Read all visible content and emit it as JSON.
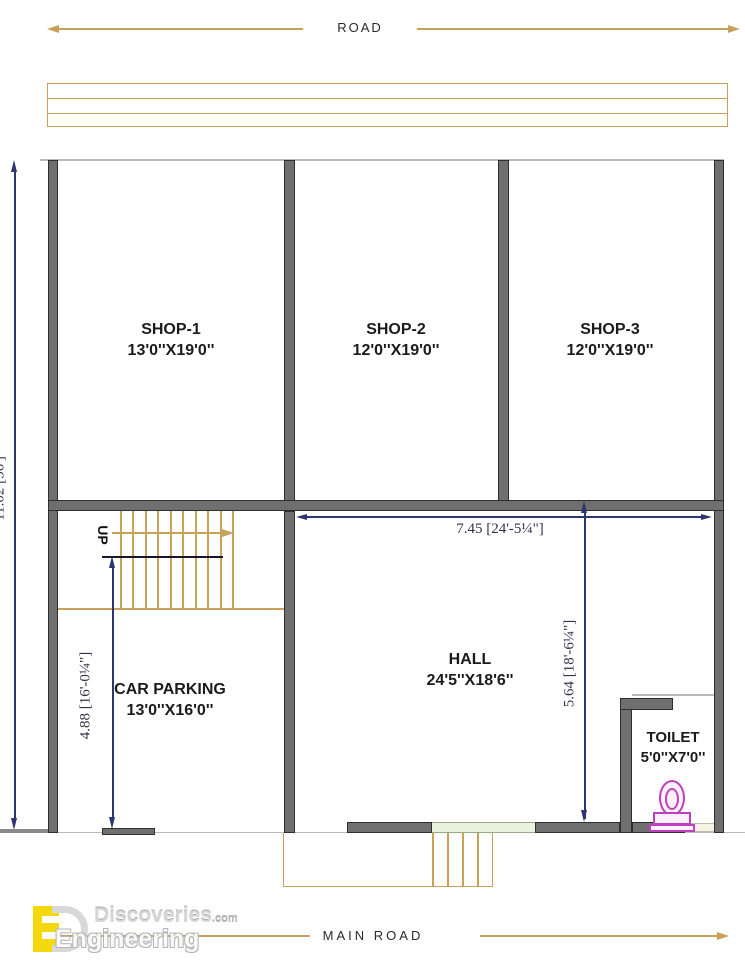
{
  "roads": {
    "top": "ROAD",
    "bottom": "MAIN ROAD"
  },
  "rooms": {
    "shop1": {
      "name": "SHOP-1",
      "size": "13'0''X19'0''"
    },
    "shop2": {
      "name": "SHOP-2",
      "size": "12'0''X19'0''"
    },
    "shop3": {
      "name": "SHOP-3",
      "size": "12'0''X19'0''"
    },
    "parking": {
      "name": "CAR PARKING",
      "size": "13'0''X16'0''"
    },
    "hall": {
      "name": "HALL",
      "size": "24'5''X18'6''"
    },
    "toilet": {
      "name": "TOILET",
      "size": "5'0''X7'0''"
    }
  },
  "stairs": {
    "up_label": "UP"
  },
  "dimensions": {
    "hall_width": "7.45 [24'-5¼\"]",
    "hall_depth": "5.64 [18'-6¼\"]",
    "parking_depth": "4.88 [16'-0¼\"]",
    "plot_depth": "11.02 [36']"
  },
  "watermark": {
    "brand_top": "Discoveries",
    "brand_top_suffix": ".com",
    "brand_bottom": "Engineering"
  },
  "colors": {
    "wall": "#6f6f6f",
    "road_line": "#c9a25a",
    "dimension": "#2c3670",
    "toilet_accent": "#bf3fbf",
    "logo_yellow": "#f2d600"
  }
}
